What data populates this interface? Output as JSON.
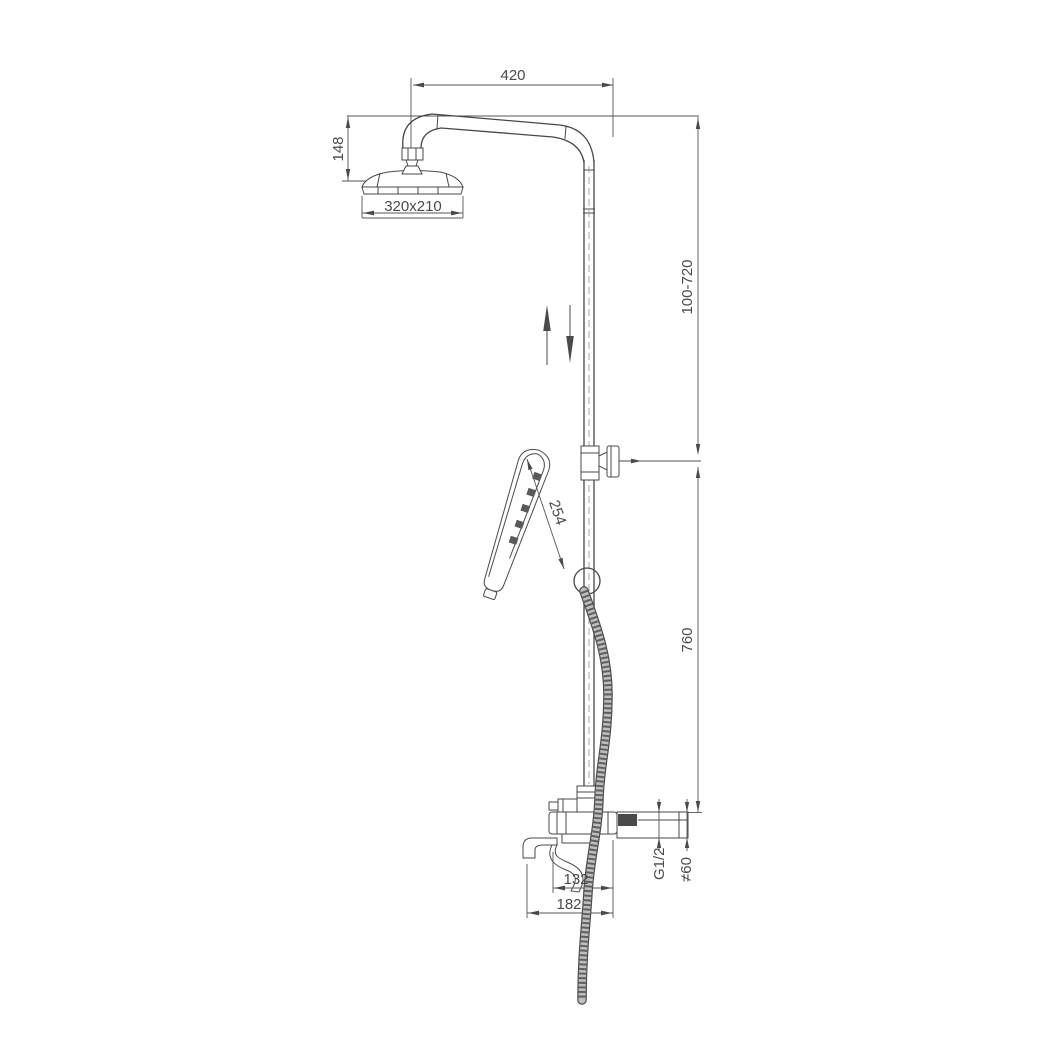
{
  "drawing": {
    "type": "technical-dimension-drawing",
    "subject": "shower column with overhead rain shower, adjustable riser, hand shower and bath spout mixer",
    "labels": {
      "arm_reach": "420",
      "arm_drop": "148",
      "head_size": "320x210",
      "riser_adjust_range": "100-720",
      "hand_shower_length": "254",
      "riser_height": "760",
      "inlet_thread": "G1/2",
      "escutcheon_diameter": "≠60",
      "spout_reach_inner": "132",
      "spout_reach_outer": "182"
    },
    "colors": {
      "line": "#4a4a4a",
      "background": "#ffffff",
      "hose_fill": "#bdbdbd"
    }
  }
}
